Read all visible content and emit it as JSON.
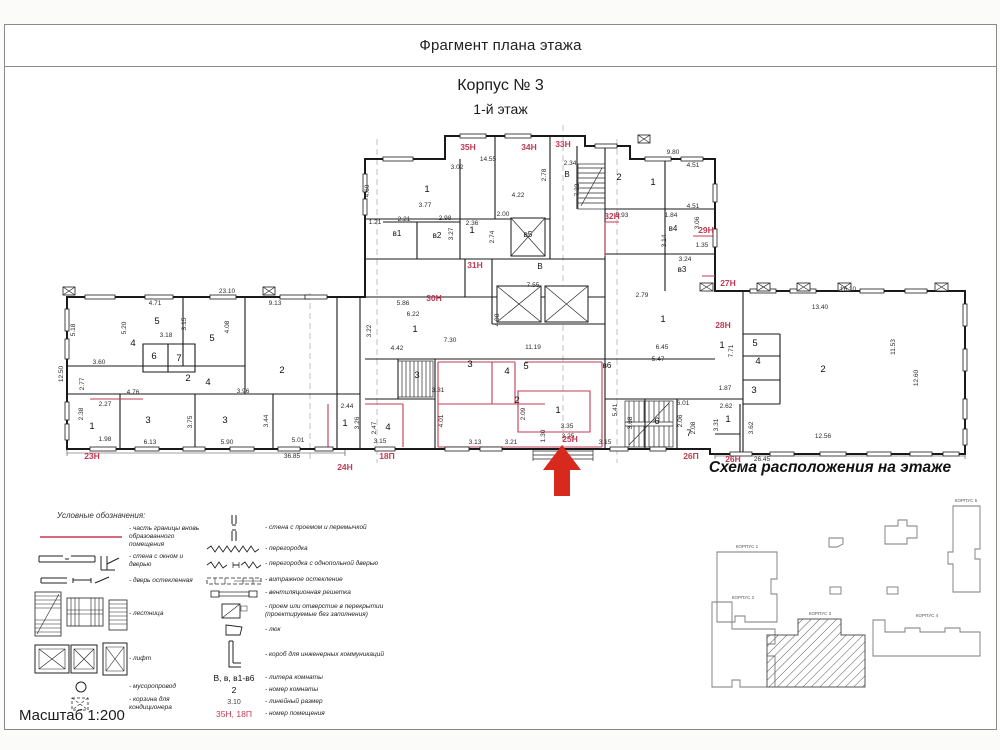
{
  "header": {
    "doc_title": "Фрагмент плана этажа",
    "building": "Корпус № 3",
    "floor": "1-й этаж"
  },
  "footer": {
    "scale": "Масштаб 1:200"
  },
  "scheme": {
    "title": "Схема расположения на этаже",
    "buildings": [
      "КОРПУС 1",
      "КОРПУС 2",
      "КОРПУС 3",
      "КОРПУС 4",
      "КОРПУС 5"
    ]
  },
  "colors": {
    "accent_red": "#c23b55",
    "arrow_red": "#d8291f",
    "wall": "#1a1a1a"
  },
  "legend": {
    "heading": "Условные обозначения:",
    "col1": [
      {
        "label": "часть границы вновь образованного помещения"
      },
      {
        "label": "стена с окном и дверью"
      },
      {
        "label": "дверь остекленная"
      },
      {
        "label": "лестница"
      },
      {
        "label": "лифт"
      },
      {
        "label": "мусоропровод"
      },
      {
        "label": "корзина для кондиционера"
      }
    ],
    "col2": [
      {
        "label": "стена с проемом и перемычкой"
      },
      {
        "label": "перегородка"
      },
      {
        "label": "перегородка с однопольной дверью"
      },
      {
        "label": "витражное остекление"
      },
      {
        "label": "вентиляционная решетка"
      },
      {
        "label": "проем или отверстие в перекрытии (проектируемые без заполнения)"
      },
      {
        "label": "люк"
      },
      {
        "label": "короб для инженерных коммуникаций"
      },
      {
        "example": "В, в, в1-в6",
        "label": "литера комнаты"
      },
      {
        "example": "2",
        "label": "номер комнаты"
      },
      {
        "example": "3.10",
        "label": "линейный размер"
      },
      {
        "example": "35Н, 18П",
        "label": "номер помещения"
      }
    ]
  },
  "plan": {
    "premise_labels": [
      {
        "t": "35Н",
        "x": 463,
        "y": 125
      },
      {
        "t": "34Н",
        "x": 524,
        "y": 125
      },
      {
        "t": "33Н",
        "x": 558,
        "y": 122
      },
      {
        "t": "32Н",
        "x": 607,
        "y": 194
      },
      {
        "t": "29Н",
        "x": 701,
        "y": 208
      },
      {
        "t": "31Н",
        "x": 470,
        "y": 243
      },
      {
        "t": "30Н",
        "x": 429,
        "y": 276
      },
      {
        "t": "27Н",
        "x": 723,
        "y": 261
      },
      {
        "t": "28Н",
        "x": 718,
        "y": 303
      },
      {
        "t": "23Н",
        "x": 87,
        "y": 434
      },
      {
        "t": "24Н",
        "x": 340,
        "y": 445
      },
      {
        "t": "18П",
        "x": 382,
        "y": 434
      },
      {
        "t": "25Н",
        "x": 565,
        "y": 417
      },
      {
        "t": "26П",
        "x": 686,
        "y": 434
      },
      {
        "t": "26Н",
        "x": 728,
        "y": 437
      }
    ],
    "room_numbers": [
      {
        "t": "4",
        "x": 128,
        "y": 321
      },
      {
        "t": "5",
        "x": 152,
        "y": 299
      },
      {
        "t": "6",
        "x": 149,
        "y": 334
      },
      {
        "t": "7",
        "x": 174,
        "y": 336
      },
      {
        "t": "5",
        "x": 207,
        "y": 316
      },
      {
        "t": "2",
        "x": 183,
        "y": 356
      },
      {
        "t": "4",
        "x": 203,
        "y": 360
      },
      {
        "t": "2",
        "x": 277,
        "y": 348
      },
      {
        "t": "3",
        "x": 143,
        "y": 398
      },
      {
        "t": "3",
        "x": 220,
        "y": 398
      },
      {
        "t": "1",
        "x": 87,
        "y": 404
      },
      {
        "t": "1",
        "x": 340,
        "y": 401
      },
      {
        "t": "4",
        "x": 383,
        "y": 405
      },
      {
        "t": "1",
        "x": 422,
        "y": 167
      },
      {
        "t": "1",
        "x": 467,
        "y": 208
      },
      {
        "t": "2",
        "x": 614,
        "y": 155
      },
      {
        "t": "1",
        "x": 648,
        "y": 160
      },
      {
        "t": "1",
        "x": 410,
        "y": 307
      },
      {
        "t": "3",
        "x": 412,
        "y": 353
      },
      {
        "t": "3",
        "x": 465,
        "y": 342
      },
      {
        "t": "4",
        "x": 502,
        "y": 349
      },
      {
        "t": "5",
        "x": 521,
        "y": 344
      },
      {
        "t": "2",
        "x": 512,
        "y": 378
      },
      {
        "t": "1",
        "x": 553,
        "y": 388
      },
      {
        "t": "6",
        "x": 652,
        "y": 399
      },
      {
        "t": "7",
        "x": 684,
        "y": 411
      },
      {
        "t": "1",
        "x": 658,
        "y": 297
      },
      {
        "t": "1",
        "x": 717,
        "y": 323
      },
      {
        "t": "5",
        "x": 750,
        "y": 321
      },
      {
        "t": "4",
        "x": 753,
        "y": 339
      },
      {
        "t": "3",
        "x": 749,
        "y": 368
      },
      {
        "t": "2",
        "x": 818,
        "y": 347
      },
      {
        "t": "1",
        "x": 723,
        "y": 397
      }
    ],
    "room_letters": [
      {
        "t": "В",
        "x": 562,
        "y": 152
      },
      {
        "t": "В",
        "x": 535,
        "y": 244
      },
      {
        "t": "в1",
        "x": 392,
        "y": 211
      },
      {
        "t": "в2",
        "x": 432,
        "y": 213
      },
      {
        "t": "в3",
        "x": 677,
        "y": 247
      },
      {
        "t": "в4",
        "x": 668,
        "y": 206
      },
      {
        "t": "в5",
        "x": 523,
        "y": 212
      },
      {
        "t": "в6",
        "x": 602,
        "y": 343
      }
    ],
    "dimensions": [
      {
        "t": "14.55",
        "x": 483,
        "y": 136
      },
      {
        "t": "9.80",
        "x": 668,
        "y": 129
      },
      {
        "t": "3.02",
        "x": 452,
        "y": 144
      },
      {
        "t": "2.34",
        "x": 565,
        "y": 140
      },
      {
        "t": "4.22",
        "x": 513,
        "y": 172
      },
      {
        "t": "4.51",
        "x": 688,
        "y": 142
      },
      {
        "t": "4.51",
        "x": 688,
        "y": 183
      },
      {
        "t": "3.77",
        "x": 420,
        "y": 182
      },
      {
        "t": "2.98",
        "x": 440,
        "y": 195
      },
      {
        "t": "2.21",
        "x": 399,
        "y": 196
      },
      {
        "t": "1.21",
        "x": 370,
        "y": 199
      },
      {
        "t": "2.36",
        "x": 467,
        "y": 200
      },
      {
        "t": "2.00",
        "x": 498,
        "y": 191
      },
      {
        "t": "5.93",
        "x": 617,
        "y": 192
      },
      {
        "t": "1.84",
        "x": 666,
        "y": 192
      },
      {
        "t": "1.35",
        "x": 697,
        "y": 222
      },
      {
        "t": "3.24",
        "x": 680,
        "y": 236
      },
      {
        "t": "2.74",
        "x": 489,
        "y": 212,
        "v": 1
      },
      {
        "t": "7.22",
        "x": 574,
        "y": 165,
        "v": 1
      },
      {
        "t": "2.78",
        "x": 541,
        "y": 150,
        "v": 1
      },
      {
        "t": "3.27",
        "x": 448,
        "y": 209,
        "v": 1
      },
      {
        "t": "3.06",
        "x": 694,
        "y": 198,
        "v": 1
      },
      {
        "t": "3.14",
        "x": 661,
        "y": 216,
        "v": 1
      },
      {
        "t": "4.60",
        "x": 364,
        "y": 166,
        "v": 1
      },
      {
        "t": "23.10",
        "x": 222,
        "y": 268
      },
      {
        "t": "9.13",
        "x": 270,
        "y": 280
      },
      {
        "t": "4.71",
        "x": 150,
        "y": 280
      },
      {
        "t": "3.18",
        "x": 161,
        "y": 312
      },
      {
        "t": "5.18",
        "x": 70,
        "y": 305,
        "v": 1
      },
      {
        "t": "5.20",
        "x": 121,
        "y": 303,
        "v": 1
      },
      {
        "t": "3.15",
        "x": 181,
        "y": 299,
        "v": 1
      },
      {
        "t": "4.08",
        "x": 224,
        "y": 302,
        "v": 1
      },
      {
        "t": "12.50",
        "x": 58,
        "y": 349,
        "v": 1
      },
      {
        "t": "3.60",
        "x": 94,
        "y": 339
      },
      {
        "t": "2.77",
        "x": 79,
        "y": 359,
        "v": 1
      },
      {
        "t": "4.76",
        "x": 128,
        "y": 369
      },
      {
        "t": "3.96",
        "x": 238,
        "y": 368
      },
      {
        "t": "2.27",
        "x": 100,
        "y": 381
      },
      {
        "t": "16.10",
        "x": 843,
        "y": 266
      },
      {
        "t": "13.40",
        "x": 815,
        "y": 284
      },
      {
        "t": "11.53",
        "x": 890,
        "y": 322,
        "v": 1
      },
      {
        "t": "12.60",
        "x": 913,
        "y": 353,
        "v": 1
      },
      {
        "t": "7.71",
        "x": 728,
        "y": 326,
        "v": 1
      },
      {
        "t": "1.87",
        "x": 720,
        "y": 365
      },
      {
        "t": "5.86",
        "x": 398,
        "y": 280
      },
      {
        "t": "6.22",
        "x": 408,
        "y": 291
      },
      {
        "t": "7.30",
        "x": 445,
        "y": 317
      },
      {
        "t": "4.42",
        "x": 392,
        "y": 325
      },
      {
        "t": "11.19",
        "x": 528,
        "y": 324
      },
      {
        "t": "7.55",
        "x": 528,
        "y": 262
      },
      {
        "t": "4.98",
        "x": 494,
        "y": 295,
        "v": 1
      },
      {
        "t": "3.22",
        "x": 366,
        "y": 306,
        "v": 1
      },
      {
        "t": "6.45",
        "x": 657,
        "y": 324
      },
      {
        "t": "2.79",
        "x": 637,
        "y": 272
      },
      {
        "t": "5.47",
        "x": 653,
        "y": 336
      },
      {
        "t": "2.62",
        "x": 721,
        "y": 383
      },
      {
        "t": "3.31",
        "x": 713,
        "y": 400,
        "v": 1
      },
      {
        "t": "3.62",
        "x": 748,
        "y": 403,
        "v": 1
      },
      {
        "t": "36.85",
        "x": 287,
        "y": 433
      },
      {
        "t": "6.13",
        "x": 145,
        "y": 419
      },
      {
        "t": "5.90",
        "x": 222,
        "y": 419
      },
      {
        "t": "5.01",
        "x": 293,
        "y": 417
      },
      {
        "t": "1.98",
        "x": 100,
        "y": 416
      },
      {
        "t": "2.38",
        "x": 78,
        "y": 389,
        "v": 1
      },
      {
        "t": "3.44",
        "x": 263,
        "y": 396,
        "v": 1
      },
      {
        "t": "3.75",
        "x": 187,
        "y": 397,
        "v": 1
      },
      {
        "t": "2.44",
        "x": 342,
        "y": 383
      },
      {
        "t": "3.26",
        "x": 354,
        "y": 398,
        "v": 1
      },
      {
        "t": "2.47",
        "x": 371,
        "y": 403,
        "v": 1
      },
      {
        "t": "3.31",
        "x": 433,
        "y": 367
      },
      {
        "t": "3.15",
        "x": 375,
        "y": 418
      },
      {
        "t": "3.13",
        "x": 470,
        "y": 419
      },
      {
        "t": "3.21",
        "x": 506,
        "y": 419
      },
      {
        "t": "3.35",
        "x": 562,
        "y": 403
      },
      {
        "t": "3.25",
        "x": 563,
        "y": 413
      },
      {
        "t": "3.15",
        "x": 600,
        "y": 419
      },
      {
        "t": "1.30",
        "x": 540,
        "y": 411,
        "v": 1
      },
      {
        "t": "2.09",
        "x": 520,
        "y": 389,
        "v": 1
      },
      {
        "t": "4.01",
        "x": 438,
        "y": 396,
        "v": 1
      },
      {
        "t": "5.41",
        "x": 612,
        "y": 385,
        "v": 1
      },
      {
        "t": "3.68",
        "x": 627,
        "y": 398,
        "v": 1
      },
      {
        "t": "6.01",
        "x": 678,
        "y": 380
      },
      {
        "t": "2.06",
        "x": 677,
        "y": 396,
        "v": 1
      },
      {
        "t": "2.08",
        "x": 690,
        "y": 403,
        "v": 1
      },
      {
        "t": "12.56",
        "x": 818,
        "y": 413
      },
      {
        "t": "26.45",
        "x": 757,
        "y": 436
      }
    ]
  }
}
